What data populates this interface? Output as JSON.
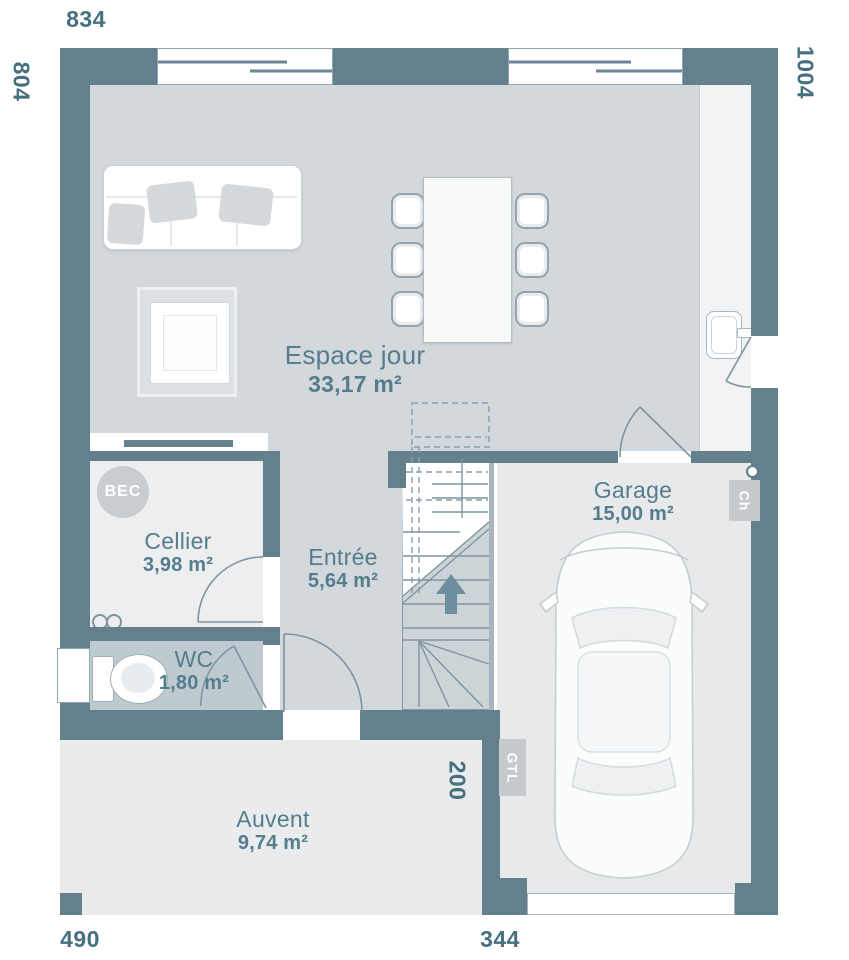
{
  "dimensions": {
    "top": "834",
    "left": "804",
    "right": "1004",
    "bottom_left": "490",
    "bottom_right": "344",
    "garage_setback": "200"
  },
  "rooms": {
    "espace_jour": {
      "name": "Espace jour",
      "area": "33,17 m²"
    },
    "cellier": {
      "name": "Cellier",
      "area": "3,98 m²"
    },
    "entree": {
      "name": "Entrée",
      "area": "5,64 m²"
    },
    "wc": {
      "name": "WC",
      "area": "1,80 m²"
    },
    "garage": {
      "name": "Garage",
      "area": "15,00 m²"
    },
    "auvent": {
      "name": "Auvent",
      "area": "9,74 m²"
    }
  },
  "annotations": {
    "bec": "BEC",
    "ch": "Ch",
    "gtl": "GTL"
  },
  "colors": {
    "wall": "#64808d",
    "living_floor": "#d2d8db",
    "cellier_floor": "#edeeef",
    "wc_floor": "#bfcad0",
    "garage_floor": "#e7e9eb",
    "auvent_floor": "#e9ebec",
    "stairs_floor": "#cdd4d8",
    "room_label": "#567d8d",
    "dimension_label": "#47707f",
    "line": "#7e959f"
  }
}
